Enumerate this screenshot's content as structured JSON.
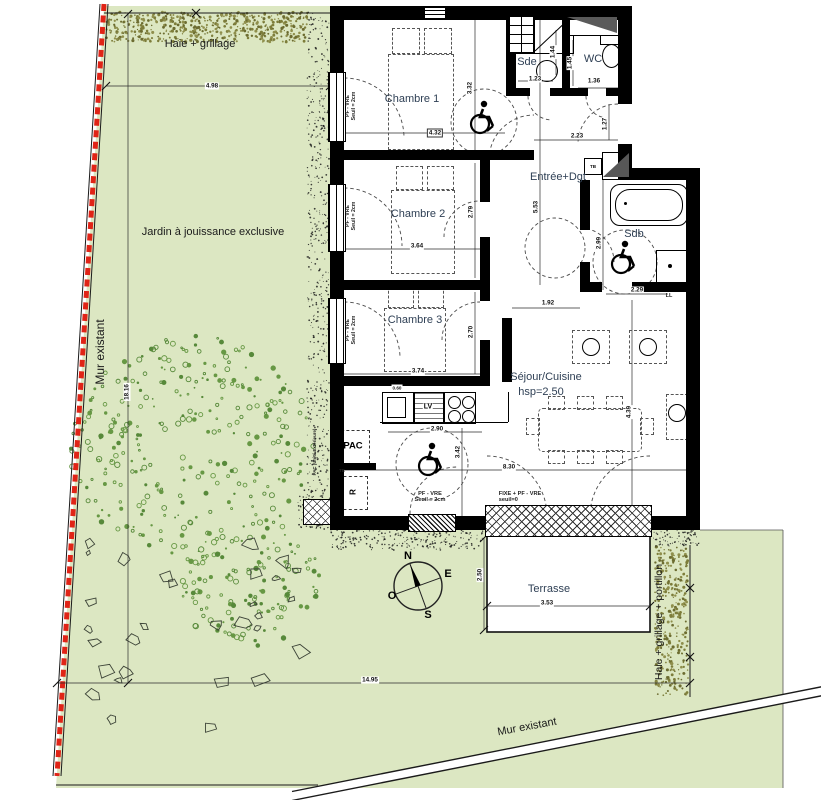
{
  "site": {
    "hedge_top": "Haie + grillage",
    "garden": "Jardin à jouissance exclusive",
    "wall_left": "Mur existant",
    "wall_bottom": "Mur existant",
    "hedge_right": "Haie + grillage + portillon"
  },
  "rooms": {
    "chambre1": "Chambre 1",
    "chambre2": "Chambre 2",
    "chambre3": "Chambre 3",
    "sde": "Sde",
    "wc": "WC",
    "entree": "Entrée+Dgt",
    "sdb": "Sdb",
    "sejour": "Séjour/Cuisine",
    "sejour_hsp": "hsp=2.50",
    "terrasse": "Terrasse"
  },
  "equipment": {
    "pac": "PAC",
    "pac_ext": "PAC (Unité Extérieure)",
    "r": "R",
    "te": "TE",
    "tb": "TB",
    "lv": "LV",
    "ll": "LL"
  },
  "openings": {
    "pf_vre": "PF - VRE",
    "seuil_2cm": "Seuil = 2cm",
    "fixe": "FIXE + PF - VRE",
    "seuil_0": "seuil=0"
  },
  "dims": {
    "d_4_98": "4.98",
    "d_18_16": "18.16",
    "d_14_95": "14.95",
    "d_4_32": "4.32",
    "d_3_32": "3.32",
    "d_1_23": "1.23",
    "d_1_44": "1.44",
    "d_1_45": "1.45",
    "d_1_36": "1.36",
    "d_2_23": "2.23",
    "d_1_27": "1.27",
    "d_5_53": "5.53",
    "d_3_64": "3.64",
    "d_2_79": "2.79",
    "d_3_74": "3.74",
    "d_2_70": "2.70",
    "d_1_92": "1.92",
    "d_2_99": "2.99",
    "d_2_29": "2.29",
    "d_2_90": "2.90",
    "d_3_42": "3.42",
    "d_8_30": "8.30",
    "d_4_39": "4.39",
    "d_2_50": "2.50",
    "d_3_53": "3.53",
    "d_0_60": "0.60"
  },
  "compass": {
    "n": "N",
    "e": "E",
    "s": "S",
    "o": "O"
  },
  "colors": {
    "garden": "#dce7c2",
    "hedge": "#7d7d3a",
    "tree": "#679844",
    "boundary_red": "#e02417",
    "wall": "#000000",
    "room_label": "#2e3f54"
  }
}
